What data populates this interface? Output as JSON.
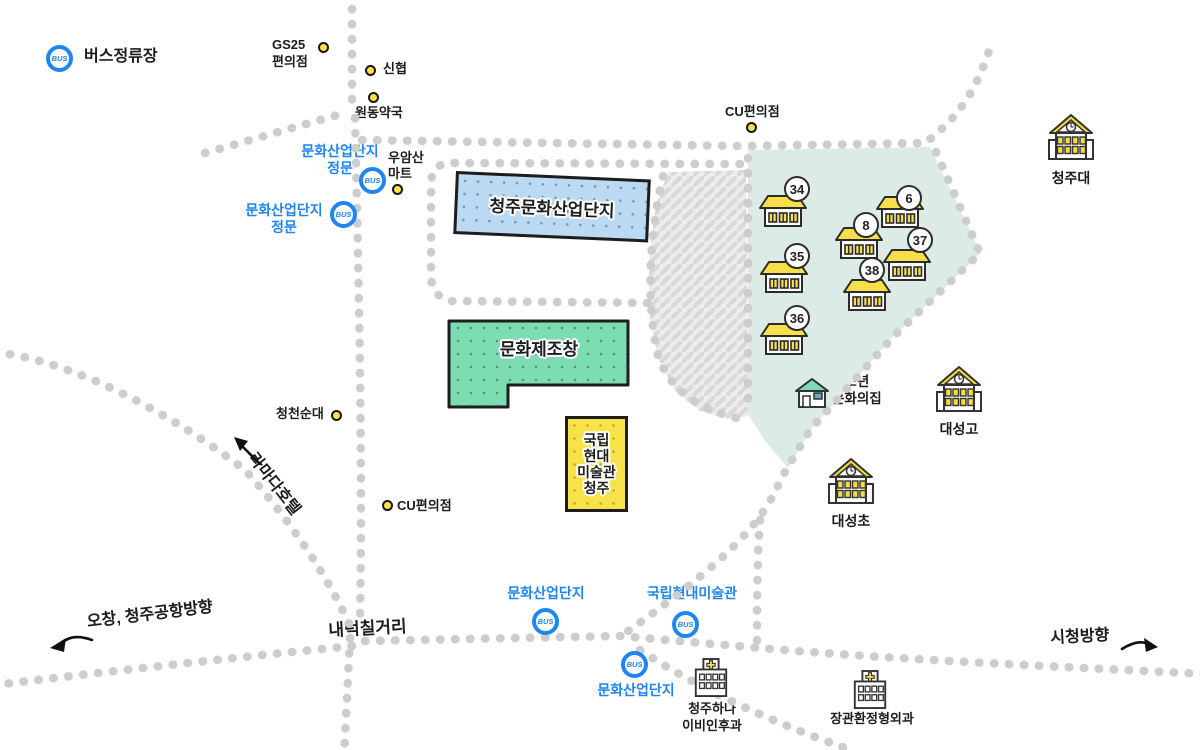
{
  "map": {
    "bus_icon_text": "BUS",
    "legend": {
      "bus_stop": "버스정류장"
    },
    "zones": {
      "dongbu_warehouse": {
        "label": "동부창고",
        "color": "#dcebe5"
      },
      "parking": {
        "line1": "문화",
        "line2": "제조창",
        "line3": "주차장"
      }
    },
    "buildings": {
      "complex": {
        "label": "청주문화산업단지",
        "color": "#bcd9f2"
      },
      "factory": {
        "label": "문화제조창",
        "color": "#7edcb2"
      },
      "museum": {
        "line1": "국립",
        "line2": "현대",
        "line3": "미술관",
        "line4": "청주",
        "color": "#f8e24a"
      }
    },
    "warehouses": [
      {
        "number": "34"
      },
      {
        "number": "35"
      },
      {
        "number": "36"
      },
      {
        "number": "6"
      },
      {
        "number": "8"
      },
      {
        "number": "37"
      },
      {
        "number": "38"
      }
    ],
    "bus_stops": {
      "gate1": {
        "line1": "문화산업단지",
        "line2": "정문"
      },
      "gate2": {
        "line1": "문화산업단지",
        "line2": "정문"
      },
      "south1": {
        "label": "문화산업단지"
      },
      "museum": {
        "label": "국립현대미술관"
      },
      "south2": {
        "label": "문화산업단지"
      }
    },
    "pois": {
      "gs25": {
        "line1": "GS25",
        "line2": "편의점"
      },
      "sinhyup": {
        "label": "신협"
      },
      "wondong_pharmacy": {
        "label": "원동약국"
      },
      "wooamsan_mart": {
        "line1": "우암산",
        "line2": "마트"
      },
      "cu_north": {
        "label": "CU편의점"
      },
      "cheongcheon_sundae": {
        "label": "청천순대"
      },
      "cu_west": {
        "label": "CU편의점"
      }
    },
    "schools": {
      "cheongju_univ": "청주대",
      "daeseong_high": "대성고",
      "daeseong_elem": "대성초"
    },
    "hospitals": {
      "hana_ent": {
        "line1": "청주하나",
        "line2": "이비인후과"
      },
      "jang_ortho": {
        "label": "장관환정형외과"
      }
    },
    "youth_center": {
      "line1": "청소년",
      "line2": "문화의집"
    },
    "directions": {
      "ochang": "오창, 청주공항방향",
      "ramada": "라마다호텔",
      "cityhall": "시청방향"
    },
    "junction": {
      "label": "내덕칠거리"
    },
    "colors": {
      "accent_blue": "#1e86f0",
      "road": "#cdcdcd",
      "poi_dot": "#ffe24a",
      "roof_yellow": "#f7df4a",
      "zone_teal": "#dcebe5"
    }
  }
}
